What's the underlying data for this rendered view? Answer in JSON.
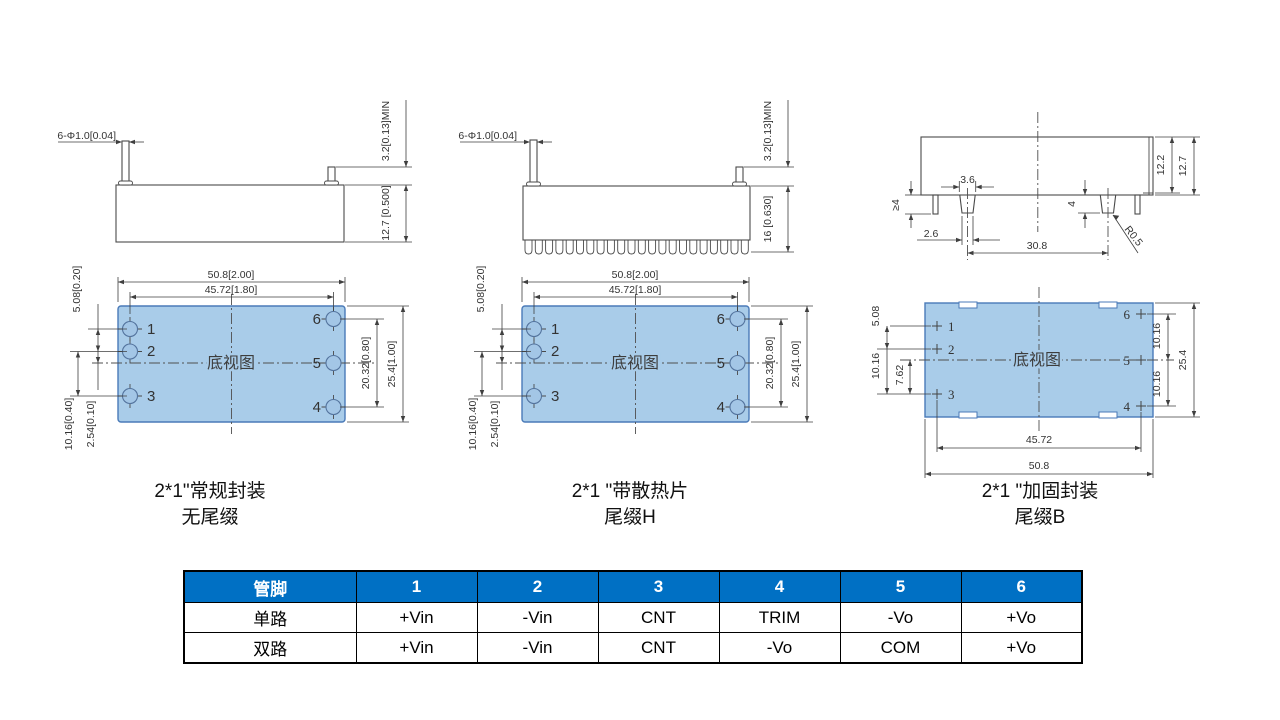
{
  "colors": {
    "module_fill": "#a9cce9",
    "module_stroke": "#4a7ab8",
    "drawing_line": "#4a4a4a",
    "table_header_bg": "#0070c4",
    "table_header_text": "#ffffff"
  },
  "modules": [
    {
      "caption1": "2*1\"常规封装",
      "caption2": "无尾缀",
      "side": {
        "callout": "6-Φ1.0[0.04]",
        "pin_min": "3.2[0.13]MIN",
        "height": "12.7 [0.500]"
      },
      "bottom": {
        "view_label": "底视图",
        "dim_w_outer": "50.8[2.00]",
        "dim_w_inner": "45.72[1.80]",
        "dim_5_08": "5.08[0.20]",
        "dim_10_16": "10.16[0.40]",
        "dim_2_54": "2.54[0.10]",
        "dim_20_32": "20.32[0.80]",
        "dim_25_4": "25.4[1.00]",
        "pin1": "1",
        "pin2": "2",
        "pin3": "3",
        "pin4": "4",
        "pin5": "5",
        "pin6": "6"
      }
    },
    {
      "caption1": "2*1 \"带散热片",
      "caption2": "尾缀H",
      "side": {
        "callout": "6-Φ1.0[0.04]",
        "pin_min": "3.2[0.13]MIN",
        "height": "16 [0.630]"
      },
      "bottom": {
        "view_label": "底视图",
        "dim_w_outer": "50.8[2.00]",
        "dim_w_inner": "45.72[1.80]",
        "dim_5_08": "5.08[0.20]",
        "dim_10_16": "10.16[0.40]",
        "dim_2_54": "2.54[0.10]",
        "dim_20_32": "20.32[0.80]",
        "dim_25_4": "25.4[1.00]",
        "pin1": "1",
        "pin2": "2",
        "pin3": "3",
        "pin4": "4",
        "pin5": "5",
        "pin6": "6"
      }
    },
    {
      "caption1": "2*1 \"加固封装",
      "caption2": "尾缀B",
      "side": {
        "d_3_6": "3.6",
        "d_ge4": "≥4",
        "d_2_6": "2.6",
        "d_4": "4",
        "d_30_8": "30.8",
        "d_12_2": "12.2",
        "d_12_7": "12.7",
        "d_r": "R0.5"
      },
      "bottom": {
        "view_label": "底视图",
        "d_5_08": "5.08",
        "d_10_16_left": "10.16",
        "d_7_62": "7.62",
        "d_10_16_r1": "10.16",
        "d_10_16_r2": "10.16",
        "d_25_4": "25.4",
        "d_45_72": "45.72",
        "d_50_8": "50.8",
        "pin1": "1",
        "pin2": "2",
        "pin3": "3",
        "pin4": "4",
        "pin5": "5",
        "pin6": "6"
      }
    }
  ],
  "pin_table": {
    "header": [
      "管脚",
      "1",
      "2",
      "3",
      "4",
      "5",
      "6"
    ],
    "rows": [
      {
        "label": "单路",
        "values": [
          "+Vin",
          "-Vin",
          "CNT",
          "TRIM",
          "-Vo",
          "+Vo"
        ]
      },
      {
        "label": "双路",
        "values": [
          "+Vin",
          "-Vin",
          "CNT",
          "-Vo",
          "COM",
          "+Vo"
        ]
      }
    ]
  }
}
